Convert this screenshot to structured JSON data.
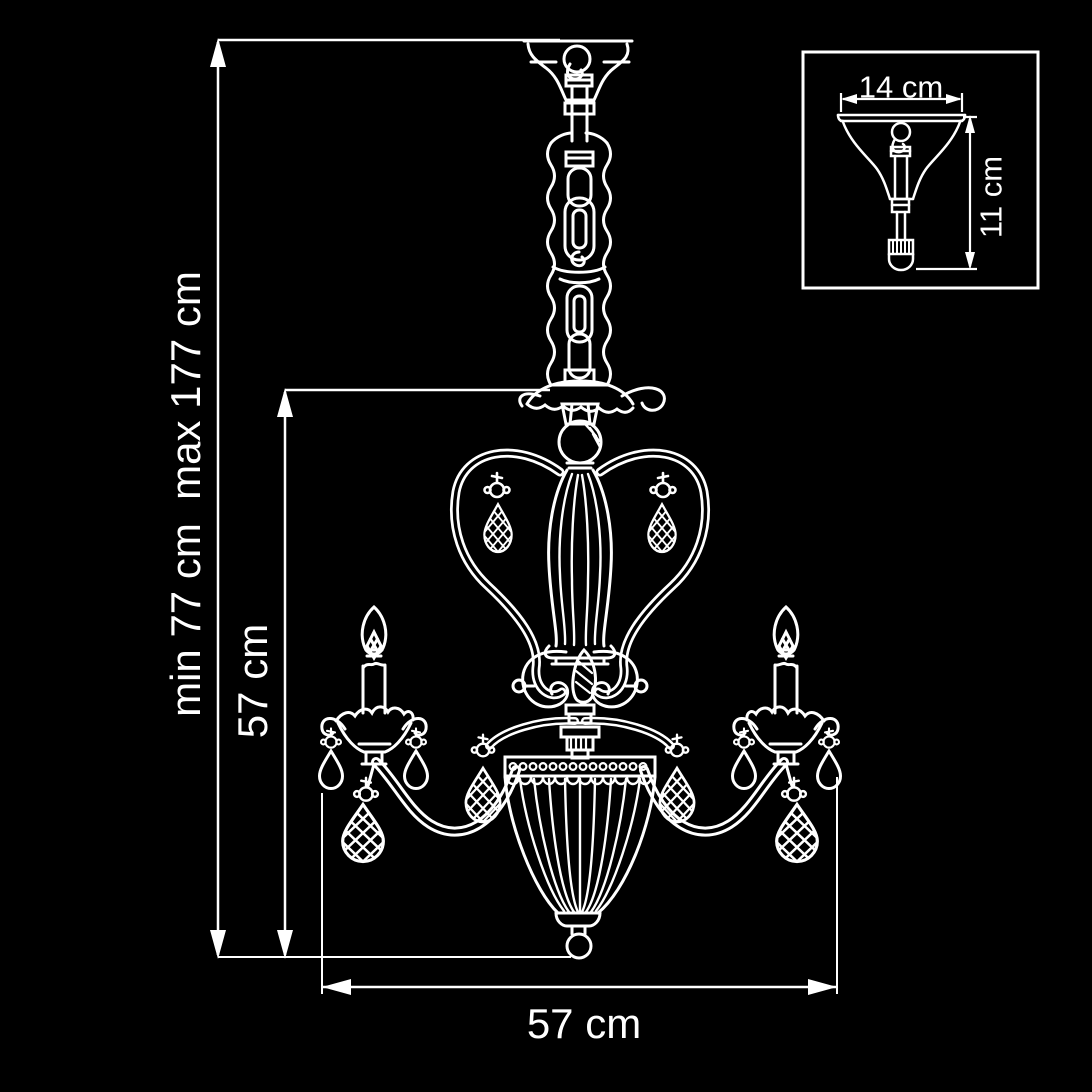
{
  "colors": {
    "background": "#000000",
    "line": "#ffffff"
  },
  "main_dimensions": {
    "height_range_label": "min 77 cm  max 177 cm",
    "hanging_height_label": "57 cm",
    "width_label": "57 cm"
  },
  "inset_detail": {
    "width_label": "14 cm",
    "height_label": "11 cm"
  }
}
